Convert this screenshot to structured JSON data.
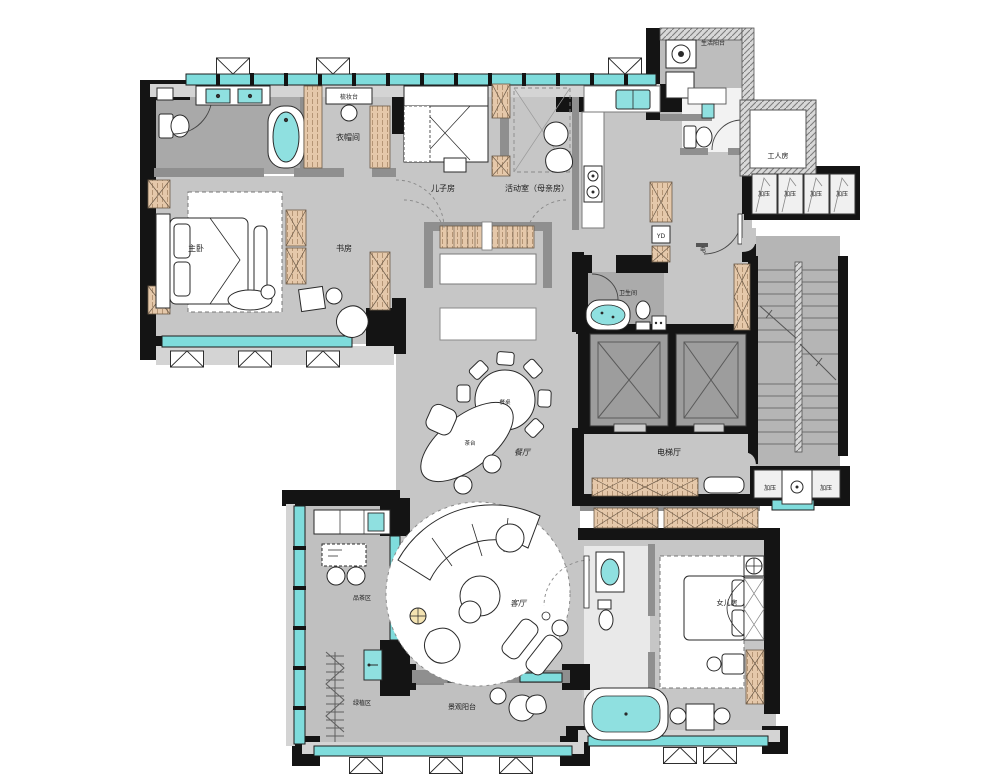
{
  "title": "apartment-floor-plan",
  "colors": {
    "floor": "#c6c6c6",
    "floor_dark": "#a9a9a9",
    "wall": "#141414",
    "wall_gray": "#8f8f8f",
    "window": "#7fdcdc",
    "cabinet": "#e5c8aa",
    "fixture_white": "#ffffff",
    "water": "#8fe0e0"
  },
  "labels": {
    "life_balcony": "生活阳台",
    "worker_room": "工人房",
    "pressure": "加压",
    "dressing_table": "梳妆台",
    "cloak_room": "衣帽间",
    "master_bedroom": "主卧",
    "study": "书房",
    "son_room": "儿子房",
    "activity_room": "活动室（母亲房）",
    "bathroom": "卫生间",
    "electric": "电",
    "yd": "YD",
    "elevator_hall": "电梯厅",
    "dining_table": "餐桌",
    "tea_table": "茶台",
    "dining_room": "餐厅",
    "living_room": "客厅",
    "tea_area": "品茶区",
    "plant_area": "绿植区",
    "view_balcony": "景观阳台",
    "daughter_room": "女儿房"
  }
}
